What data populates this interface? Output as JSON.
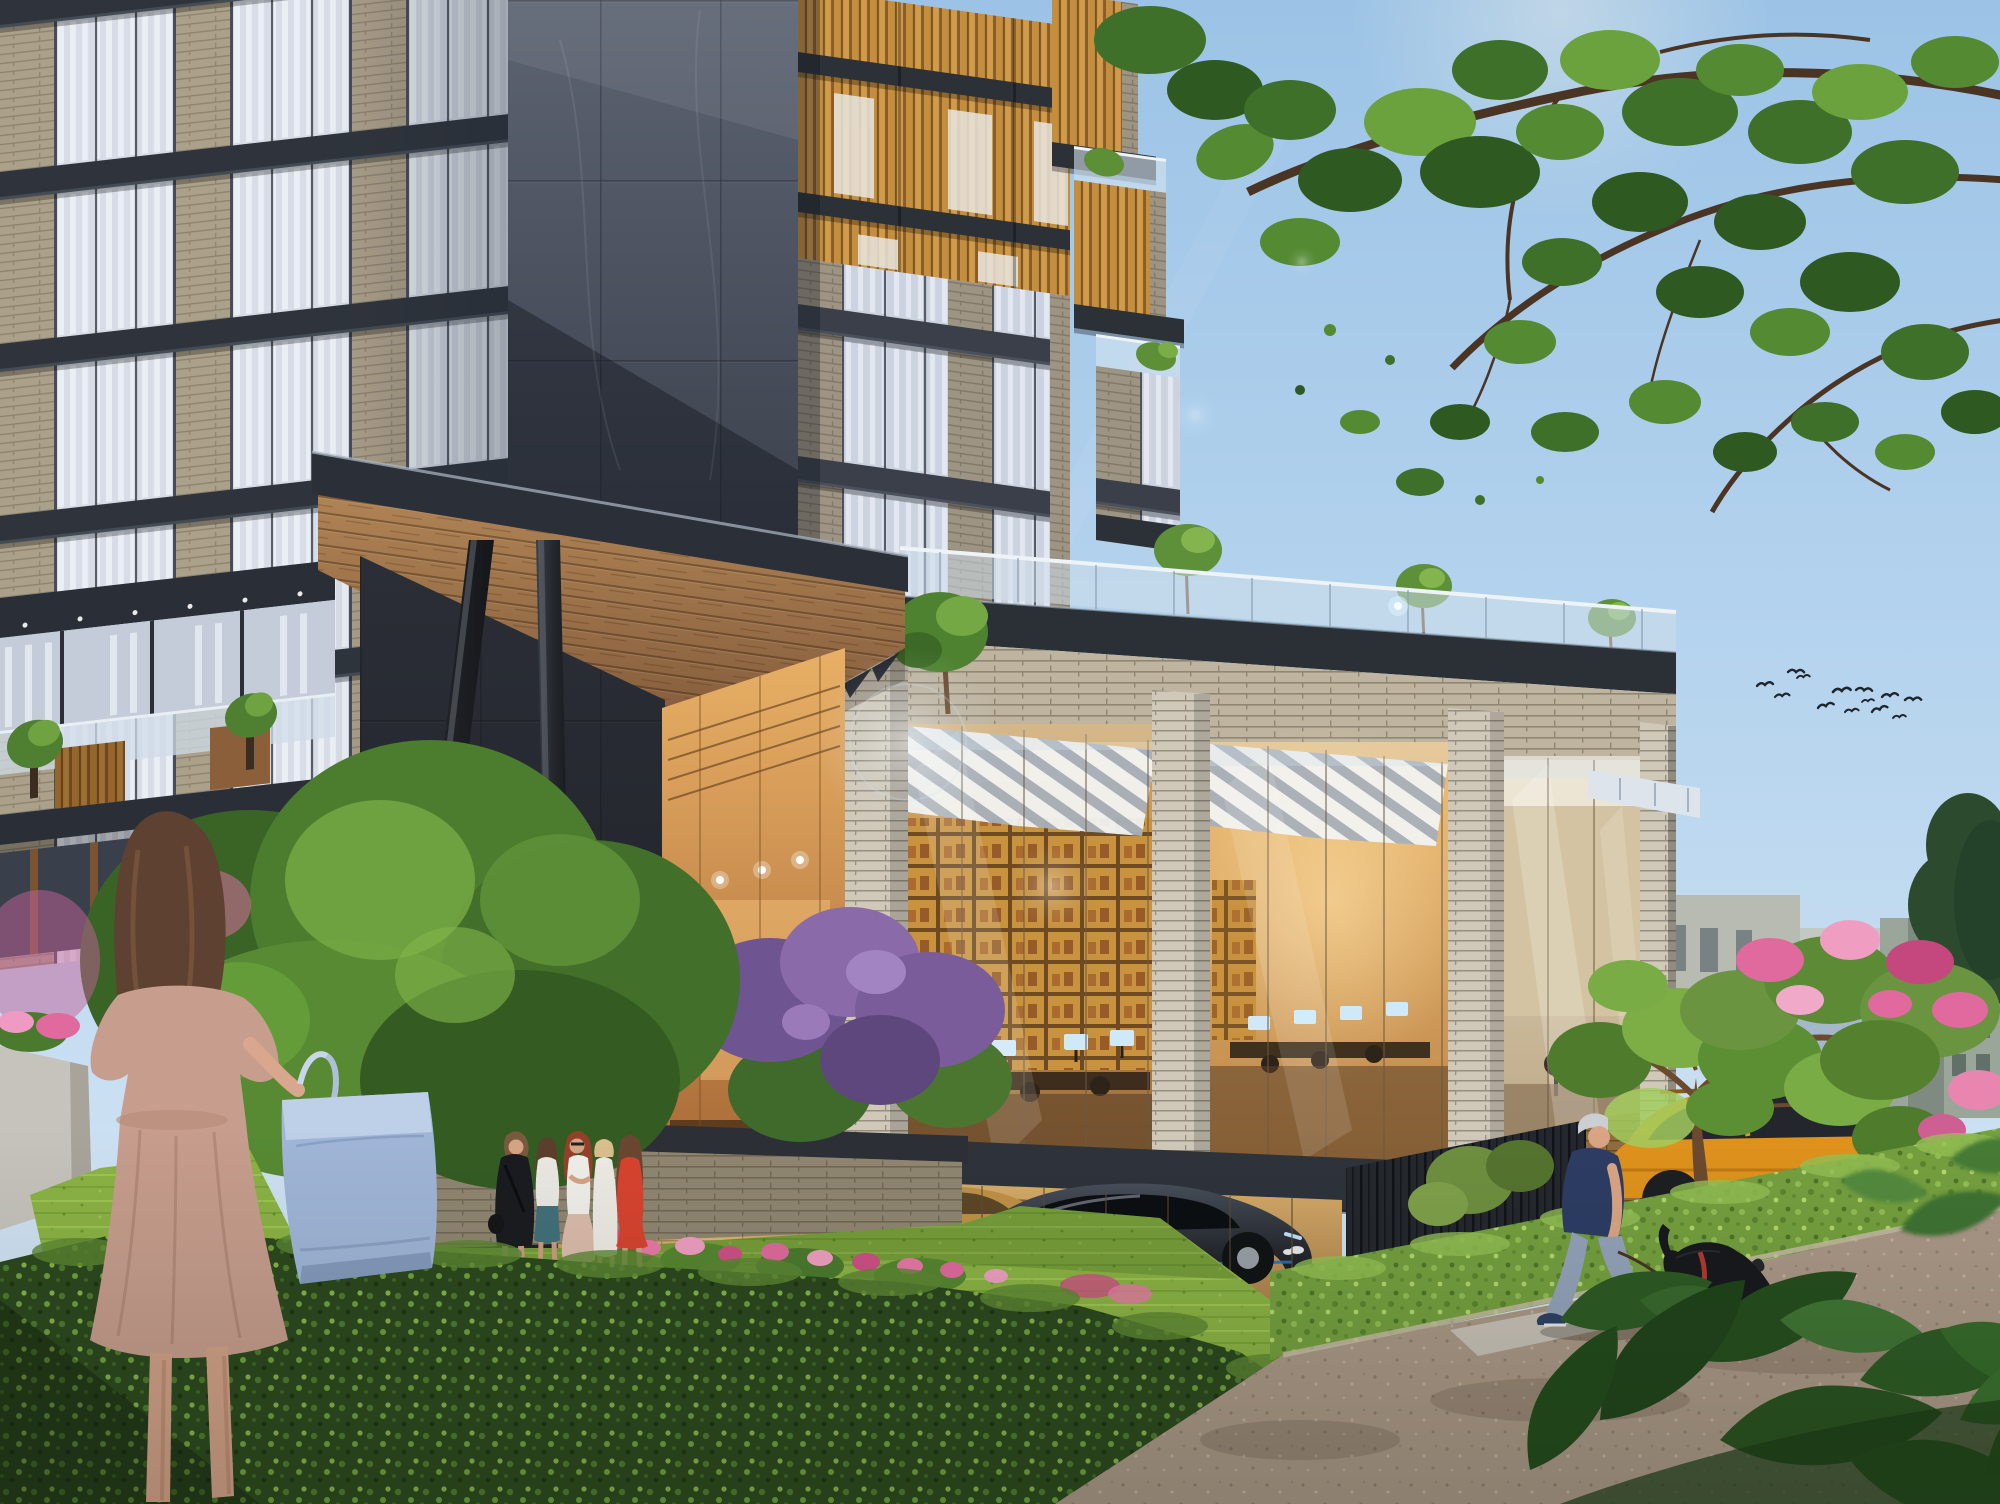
{
  "palette": {
    "sky_top": "#9cc3e6",
    "sky_mid": "#b6d4ee",
    "sky_bottom": "#dceaf6",
    "foliage_dark": "#2e5a22",
    "foliage_mid": "#548a31",
    "foliage_light": "#85b94e",
    "branch_brown": "#4a3524",
    "slab_dark": "#2e333b",
    "marble_dark": "#3c414d",
    "brick_light": "#beb4a0",
    "brick_grey": "#d0c9ba",
    "brick_warm": "#c79c58",
    "wood_slat": "#c38e3e",
    "soffit_wood": "#a97c4e",
    "glass_blue": "#d7dce7",
    "curtain_white": "#eef2f7",
    "interior_amber": "#d8a55c",
    "interior_glow": "#ffe2a8",
    "hedge_dark": "#2b481d",
    "hedge_light": "#75a03f",
    "lawn_green": "#8bb344",
    "path_taupe": "#ab9887",
    "flower_pink": "#e06a9d",
    "flower_magenta": "#cf4f86",
    "lilac_purple": "#8a6aa8",
    "mountain_haze": "#a9bccd",
    "concrete_grey": "#b7bbb2",
    "conifer_green": "#2c4b2e",
    "suv_orange": "#e0921c",
    "sedan_gold": "#c09146",
    "sportscar_black": "#14161a",
    "headlight_blue": "#bfe3ff",
    "skin": "#d6a385",
    "hair_brown": "#5e4130",
    "dress_blush": "#c79d8d",
    "tote_blue": "#a0b6d8",
    "dress_black": "#1a1b20",
    "top_white": "#ebe9e4",
    "skirt_teal": "#41707a",
    "skirt_blush": "#dcbcac",
    "dress_white": "#eeebe4",
    "dress_red": "#d8432f",
    "shirt_navy": "#2c3c64",
    "pants_grey": "#94a3bb",
    "shoe_navy": "#2b4066",
    "leash_red": "#cf4a3c",
    "dog_black": "#16181c",
    "bird_dark": "#1f252d",
    "awning_white": "#f2f3f1",
    "monitor_screen": "#cfe9f9"
  },
  "scene": {
    "counts": {
      "birds": 13,
      "group_pedestrians": 5,
      "walking_man": 1,
      "foreground_woman": 1,
      "dog": 1,
      "cars_visible": 3,
      "rooftop_trees": 3
    }
  }
}
